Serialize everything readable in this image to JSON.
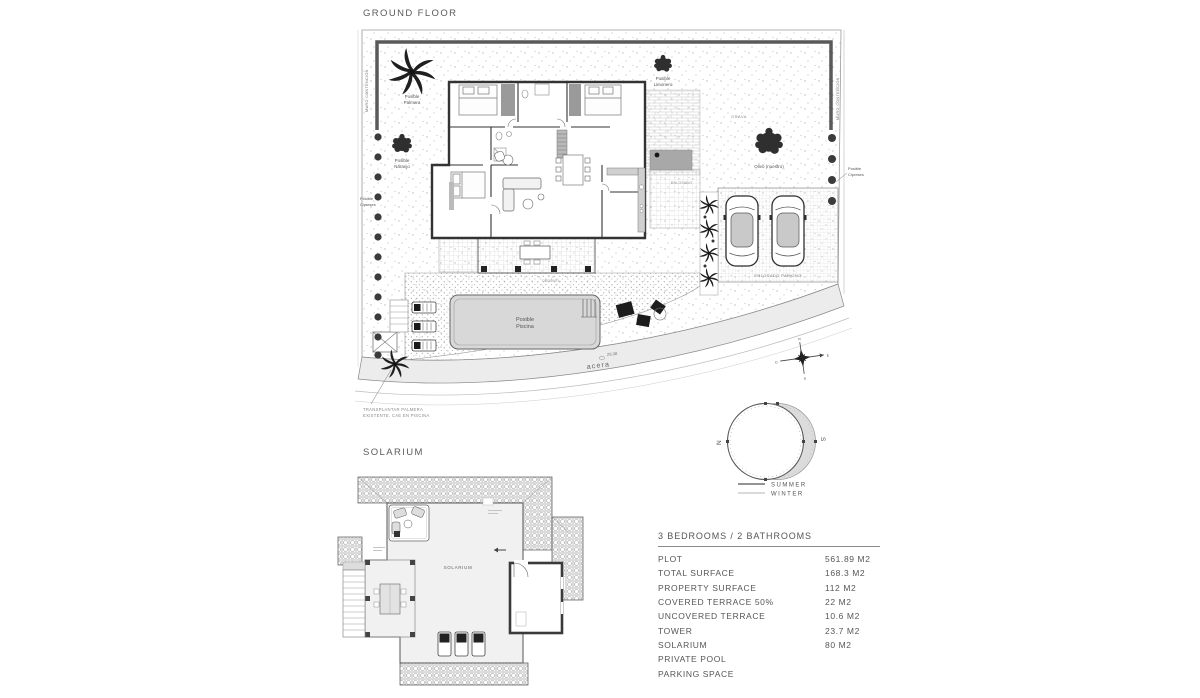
{
  "ground_floor": {
    "title": "GROUND FLOOR",
    "plan_labels": {
      "muro_left": "MURO CONTENCIÓN",
      "muro_right": "MURO CONTENCIÓN",
      "palmera_line1": "Posible",
      "palmera_line2": "Palmera",
      "naranjo_line1": "Posible",
      "naranjo_line2": "Naranjo",
      "limonero_line1": "Posible",
      "limonero_line2": "Limonero",
      "cipreses_left_line1": "Posible",
      "cipreses_left_line2": "Cipreses",
      "cipreses_right_line1": "Posible",
      "cipreses_right_line2": "Cipreses",
      "olivo": "Olivo (nuestro)",
      "grava": "GRAVA",
      "enlosado": "ENLOSADO",
      "enlosado_parking": "ENLOSADO PARKING",
      "piscina_line1": "Posible",
      "piscina_line2": "Piscina",
      "acera": "acera",
      "road_dim": "29.38",
      "desnivel": "DESNIVEL",
      "note_line1": "TRANSPLANTAR PALMERA",
      "note_line2": "EXISTENTE. CAE EN PISCINA",
      "compass_n": "N",
      "compass_s": "S",
      "compass_e": "E",
      "compass_o": "O"
    }
  },
  "solarium": {
    "title": "SOLARIUM",
    "room_label": "SOLARIUM"
  },
  "sun_diagram": {
    "north": "N",
    "south": "S",
    "legend": {
      "summer": "SUMMER",
      "winter": "WINTER"
    }
  },
  "spec_table": {
    "header": "3 BEDROOMS / 2 BATHROOMS",
    "rows": [
      {
        "label": "PLOT",
        "value": "561.89 M2"
      },
      {
        "label": "TOTAL SURFACE",
        "value": "168.3 M2"
      },
      {
        "label": "PROPERTY SURFACE",
        "value": "112 M2"
      },
      {
        "label": "COVERED TERRACE 50%",
        "value": "22 M2"
      },
      {
        "label": "UNCOVERED TERRACE",
        "value": "10.6 M2"
      },
      {
        "label": "TOWER",
        "value": "23.7 M2"
      },
      {
        "label": "SOLARIUM",
        "value": "80 M2"
      },
      {
        "label": "PRIVATE POOL",
        "value": ""
      },
      {
        "label": "PARKING SPACE",
        "value": ""
      }
    ]
  },
  "colors": {
    "line_dark": "#3a3a3a",
    "line_mid": "#777777",
    "text_gray": "#55565a",
    "pool_fill": "#d8d8d8",
    "road_fill": "#ececec",
    "winter_shade": "#dcdcdc"
  }
}
